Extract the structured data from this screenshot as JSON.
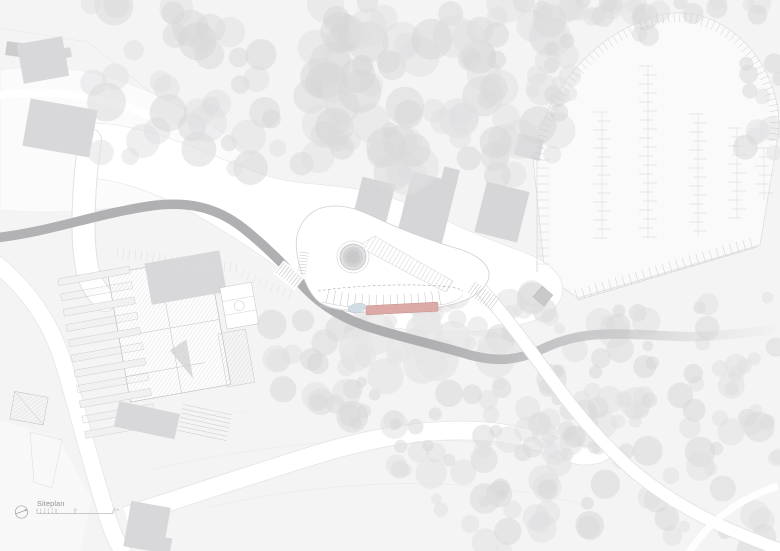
{
  "title_block": {
    "title": "Siteplan"
  },
  "scale_bar": {
    "unit_suffix": "m",
    "ticks": [
      {
        "m": 0,
        "label": "0"
      },
      {
        "m": 1,
        "label": "1"
      },
      {
        "m": 2,
        "label": "2"
      },
      {
        "m": 3,
        "label": "3"
      },
      {
        "m": 4,
        "label": "4"
      },
      {
        "m": 5,
        "label": "5"
      },
      {
        "m": 10,
        "label": "10"
      },
      {
        "m": 20,
        "label": "20 m"
      }
    ]
  },
  "icons": {
    "north_arrow": "north-arrow-icon"
  },
  "colors": {
    "background": "#f4f4f5",
    "paper_white": "#ffffff",
    "zone_light": "#fbfbfc",
    "tree": "#e0e0e1",
    "tree_dark": "#d5d5d6",
    "context_building": "#d8d8da",
    "context_building_dark": "#cdcdcf",
    "stream": "#b2b2b4",
    "hatch": "#cbcbcd",
    "outline": "#c9c9cb",
    "accent_building": "#dba6a3",
    "accent_outline": "#c79390",
    "water_feature": "#cfdae2",
    "text": "#8e8e90"
  }
}
